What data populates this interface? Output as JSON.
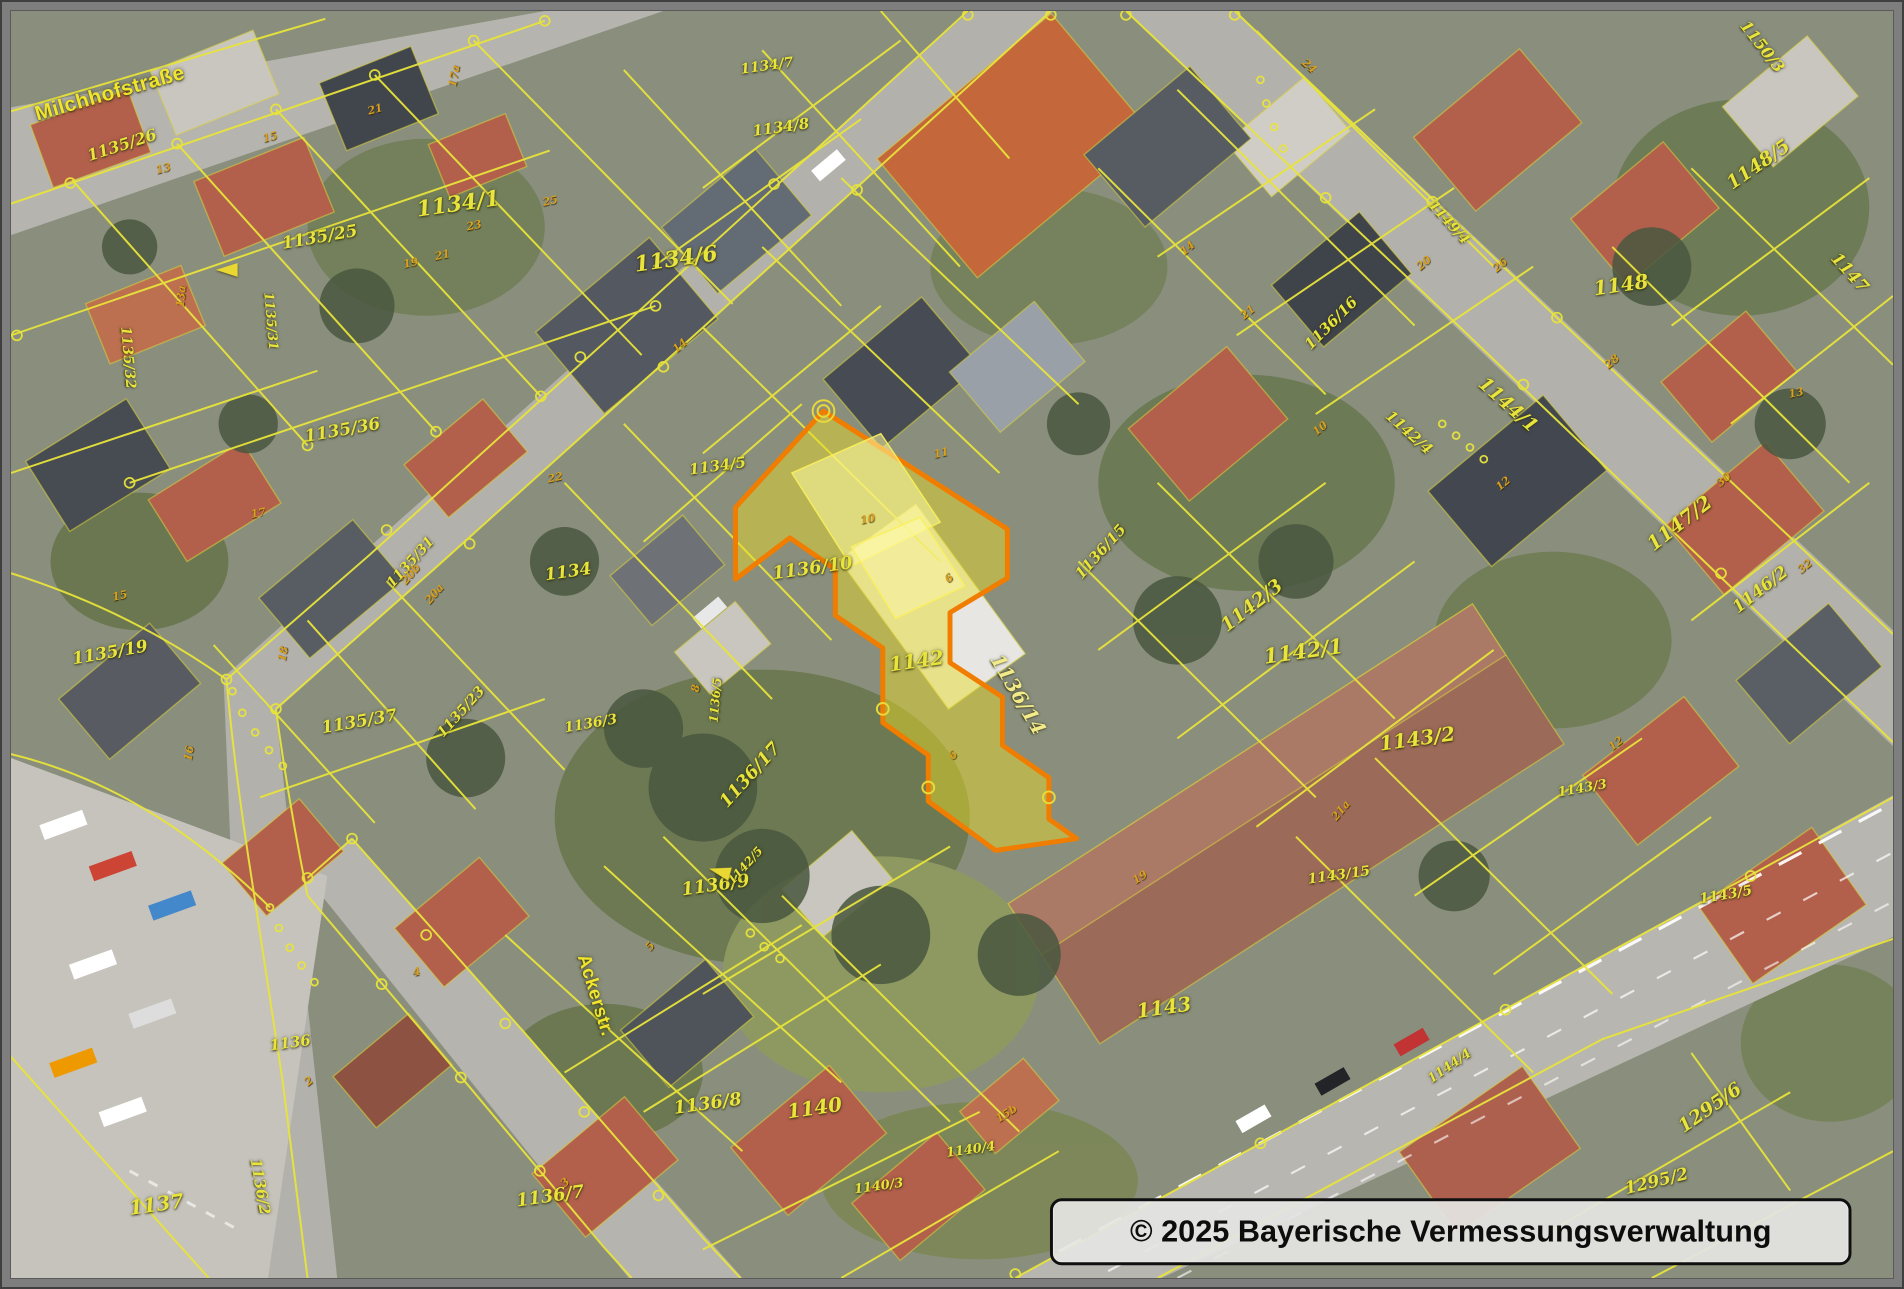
{
  "copyright": "© 2025 Bayerische Vermessungsverwaltung",
  "highlight": {
    "parcel": "1136/14",
    "fill_color": "#e8dc28",
    "stroke_color": "#f07d00"
  },
  "colors": {
    "parcel_line": "#e8e43a",
    "parcel_label": "#e9e43b",
    "house_number": "#d9a01e",
    "street_label": "#f0e52c"
  },
  "streets": [
    {
      "t": "Milchhofstraße",
      "x": 100,
      "y": 84,
      "r": -16,
      "s": 21
    },
    {
      "t": "Ackerstr.",
      "x": 590,
      "y": 1000,
      "r": 73,
      "s": 19
    }
  ],
  "parcel_labels": [
    {
      "t": "1135/26",
      "x": 112,
      "y": 136,
      "r": -18,
      "s": 16
    },
    {
      "t": "1134/1",
      "x": 452,
      "y": 196,
      "r": -8,
      "s": 22
    },
    {
      "t": "1135/25",
      "x": 312,
      "y": 230,
      "r": -10,
      "s": 17
    },
    {
      "t": "1135/36",
      "x": 335,
      "y": 426,
      "r": -10,
      "s": 17
    },
    {
      "t": "1135/19",
      "x": 100,
      "y": 652,
      "r": -10,
      "s": 17
    },
    {
      "t": "1135/32",
      "x": 118,
      "y": 352,
      "r": 85,
      "s": 14
    },
    {
      "t": "1135/31",
      "x": 262,
      "y": 315,
      "r": 85,
      "s": 13
    },
    {
      "t": "1135/31",
      "x": 404,
      "y": 560,
      "r": -48,
      "s": 14
    },
    {
      "t": "1134",
      "x": 563,
      "y": 570,
      "r": -8,
      "s": 17
    },
    {
      "t": "1135/37",
      "x": 352,
      "y": 722,
      "r": -10,
      "s": 17
    },
    {
      "t": "1135/23",
      "x": 455,
      "y": 712,
      "r": -48,
      "s": 14
    },
    {
      "t": "1136/3",
      "x": 586,
      "y": 724,
      "r": -10,
      "s": 14
    },
    {
      "t": "1134/5",
      "x": 714,
      "y": 462,
      "r": -8,
      "s": 15
    },
    {
      "t": "1134/6",
      "x": 672,
      "y": 252,
      "r": -8,
      "s": 22
    },
    {
      "t": "1134/8",
      "x": 778,
      "y": 118,
      "r": -8,
      "s": 15
    },
    {
      "t": "1134/7",
      "x": 764,
      "y": 56,
      "r": -8,
      "s": 14
    },
    {
      "t": "1136/10",
      "x": 810,
      "y": 566,
      "r": -8,
      "s": 18
    },
    {
      "t": "1142",
      "x": 915,
      "y": 660,
      "r": -8,
      "s": 20
    },
    {
      "t": "1136/15",
      "x": 1101,
      "y": 549,
      "r": -48,
      "s": 15
    },
    {
      "t": "1136/16",
      "x": 1334,
      "y": 317,
      "r": -45,
      "s": 15
    },
    {
      "t": "1142/4",
      "x": 1413,
      "y": 428,
      "r": 42,
      "s": 15
    },
    {
      "t": "1142/3",
      "x": 1254,
      "y": 604,
      "r": -38,
      "s": 19
    },
    {
      "t": "1142/1",
      "x": 1306,
      "y": 650,
      "r": -8,
      "s": 21
    },
    {
      "t": "1143/2",
      "x": 1421,
      "y": 739,
      "r": -8,
      "s": 20
    },
    {
      "t": "1144/1",
      "x": 1513,
      "y": 400,
      "r": 42,
      "s": 19
    },
    {
      "t": "1149/4",
      "x": 1453,
      "y": 215,
      "r": 48,
      "s": 14
    },
    {
      "t": "1148",
      "x": 1627,
      "y": 278,
      "r": -8,
      "s": 20
    },
    {
      "t": "1148/5",
      "x": 1766,
      "y": 156,
      "r": -35,
      "s": 19
    },
    {
      "t": "1150/3",
      "x": 1770,
      "y": 36,
      "r": 52,
      "s": 16
    },
    {
      "t": "1147",
      "x": 1858,
      "y": 266,
      "r": 48,
      "s": 17
    },
    {
      "t": "1147/2",
      "x": 1686,
      "y": 520,
      "r": -38,
      "s": 20
    },
    {
      "t": "1146/2",
      "x": 1768,
      "y": 588,
      "r": -38,
      "s": 17
    },
    {
      "t": "1143/3",
      "x": 1588,
      "y": 790,
      "r": -10,
      "s": 13
    },
    {
      "t": "1143/5",
      "x": 1733,
      "y": 898,
      "r": -10,
      "s": 14
    },
    {
      "t": "1143/15",
      "x": 1342,
      "y": 878,
      "r": -8,
      "s": 14
    },
    {
      "t": "1136/9",
      "x": 712,
      "y": 888,
      "r": -8,
      "s": 18
    },
    {
      "t": "1142/5",
      "x": 742,
      "y": 868,
      "r": -48,
      "s": 12
    },
    {
      "t": "1136/8",
      "x": 704,
      "y": 1110,
      "r": -8,
      "s": 18
    },
    {
      "t": "1140",
      "x": 812,
      "y": 1114,
      "r": -8,
      "s": 20
    },
    {
      "t": "1143",
      "x": 1165,
      "y": 1012,
      "r": -8,
      "s": 20
    },
    {
      "t": "1140/4",
      "x": 970,
      "y": 1157,
      "r": -8,
      "s": 13
    },
    {
      "t": "1140/3",
      "x": 877,
      "y": 1194,
      "r": -8,
      "s": 13
    },
    {
      "t": "1137",
      "x": 147,
      "y": 1212,
      "r": -8,
      "s": 20
    },
    {
      "t": "1136/2",
      "x": 252,
      "y": 1194,
      "r": 80,
      "s": 15
    },
    {
      "t": "1136",
      "x": 282,
      "y": 1048,
      "r": -8,
      "s": 15
    },
    {
      "t": "1136/7",
      "x": 545,
      "y": 1204,
      "r": -8,
      "s": 18
    },
    {
      "t": "1295/6",
      "x": 1717,
      "y": 1114,
      "r": -35,
      "s": 19
    },
    {
      "t": "1295/2",
      "x": 1663,
      "y": 1189,
      "r": -14,
      "s": 17
    },
    {
      "t": "1144/4",
      "x": 1454,
      "y": 1072,
      "r": -35,
      "s": 13
    },
    {
      "t": "1136/5",
      "x": 712,
      "y": 700,
      "r": -85,
      "s": 12
    },
    {
      "t": "1136/17",
      "x": 747,
      "y": 776,
      "r": -48,
      "s": 18
    },
    {
      "t": "1136/14",
      "x": 1018,
      "y": 694,
      "r": 60,
      "s": 20,
      "c": "#f3eb8a"
    }
  ],
  "house_numbers": [
    {
      "t": "13",
      "x": 154,
      "y": 160,
      "r": -15
    },
    {
      "t": "15",
      "x": 262,
      "y": 128,
      "r": -15
    },
    {
      "t": "21",
      "x": 368,
      "y": 100,
      "r": -15
    },
    {
      "t": "17a",
      "x": 448,
      "y": 66,
      "r": -80
    },
    {
      "t": "19",
      "x": 404,
      "y": 256,
      "r": -12
    },
    {
      "t": "21",
      "x": 436,
      "y": 248,
      "r": -12
    },
    {
      "t": "23",
      "x": 468,
      "y": 218,
      "r": -12
    },
    {
      "t": "25",
      "x": 545,
      "y": 193,
      "r": -12
    },
    {
      "t": "17",
      "x": 250,
      "y": 510,
      "r": -12
    },
    {
      "t": "15",
      "x": 110,
      "y": 594,
      "r": -12
    },
    {
      "t": "22",
      "x": 550,
      "y": 474,
      "r": -12
    },
    {
      "t": "20b",
      "x": 404,
      "y": 572,
      "r": -50
    },
    {
      "t": "20a",
      "x": 428,
      "y": 592,
      "r": -50
    },
    {
      "t": "18",
      "x": 275,
      "y": 653,
      "r": -80
    },
    {
      "t": "16",
      "x": 180,
      "y": 754,
      "r": -80
    },
    {
      "t": "13a",
      "x": 172,
      "y": 290,
      "r": -85
    },
    {
      "t": "24",
      "x": 1312,
      "y": 56,
      "r": 42
    },
    {
      "t": "26",
      "x": 1505,
      "y": 258,
      "r": -40
    },
    {
      "t": "28",
      "x": 1618,
      "y": 356,
      "r": -40
    },
    {
      "t": "30",
      "x": 1731,
      "y": 476,
      "r": -40
    },
    {
      "t": "32",
      "x": 1813,
      "y": 564,
      "r": -40
    },
    {
      "t": "14",
      "x": 1189,
      "y": 241,
      "r": -40
    },
    {
      "t": "21",
      "x": 1250,
      "y": 306,
      "r": -40
    },
    {
      "t": "10",
      "x": 1323,
      "y": 424,
      "r": -40
    },
    {
      "t": "20",
      "x": 1428,
      "y": 256,
      "r": -40
    },
    {
      "t": "12",
      "x": 1508,
      "y": 480,
      "r": -40
    },
    {
      "t": "13",
      "x": 1804,
      "y": 388,
      "r": -12
    },
    {
      "t": "6",
      "x": 948,
      "y": 576,
      "r": -40
    },
    {
      "t": "10",
      "x": 866,
      "y": 516,
      "r": -12
    },
    {
      "t": "11",
      "x": 940,
      "y": 449,
      "r": -12
    },
    {
      "t": "8",
      "x": 692,
      "y": 688,
      "r": -80
    },
    {
      "t": "6",
      "x": 952,
      "y": 756,
      "r": -50
    },
    {
      "t": "21a",
      "x": 1344,
      "y": 812,
      "r": -50
    },
    {
      "t": "19",
      "x": 1141,
      "y": 880,
      "r": -33
    },
    {
      "t": "15b",
      "x": 1006,
      "y": 1120,
      "r": -33
    },
    {
      "t": "5",
      "x": 646,
      "y": 950,
      "r": -50
    },
    {
      "t": "4",
      "x": 410,
      "y": 976,
      "r": -12
    },
    {
      "t": "2",
      "x": 301,
      "y": 1087,
      "r": -40
    },
    {
      "t": "3",
      "x": 560,
      "y": 1190,
      "r": -45
    },
    {
      "t": "14",
      "x": 676,
      "y": 340,
      "r": -40
    },
    {
      "t": "12",
      "x": 1622,
      "y": 744,
      "r": -38
    }
  ],
  "markers": [
    {
      "name": "reference-arrow",
      "x": 218,
      "y": 263,
      "a": 0
    },
    {
      "name": "reference-arrow",
      "x": 716,
      "y": 874,
      "a": 15
    }
  ]
}
